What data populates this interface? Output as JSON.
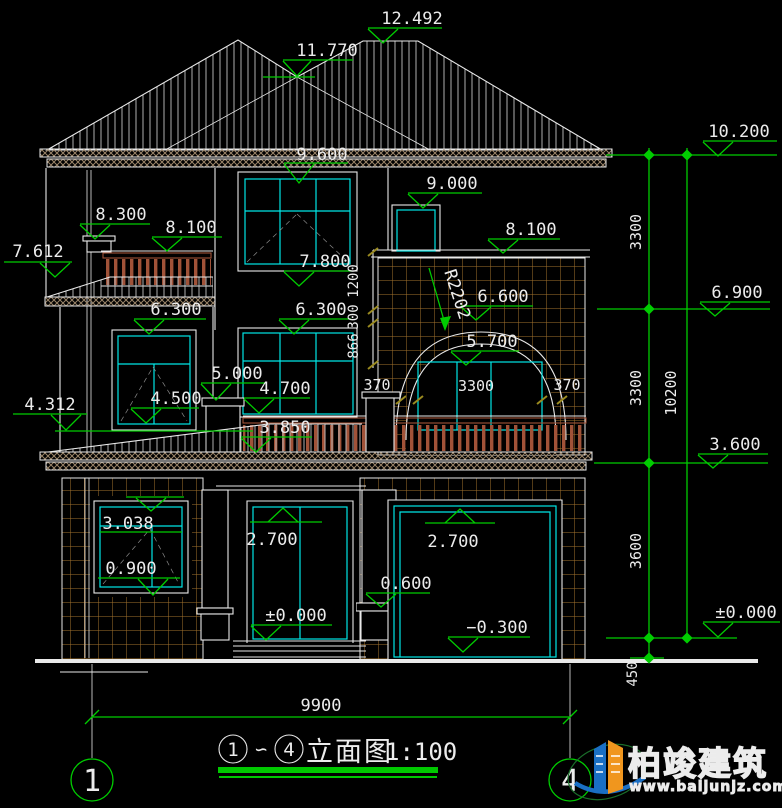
{
  "levels": {
    "ridge": "12.492",
    "hip": "11.770",
    "eave_right": "10.200",
    "eave": "9.600",
    "chimney_top": "9.000",
    "left_post": "8.300",
    "left_balcony": "8.100",
    "left_roof": "7.612",
    "big_window": "7.800",
    "flat_roof_right": "8.100",
    "second_floor_right": "6.900",
    "window2_left": "6.300",
    "window2_center": "6.300",
    "arch_top": "6.600",
    "arch_window": "5.700",
    "pedestal": "5.000",
    "window2_mid": "4.700",
    "window2_sill": "4.500",
    "roof1_eave_left": "4.312",
    "railing_base": "3.850",
    "first_roof_right": "3.600",
    "window1_head": "3.038",
    "door_head": "2.700",
    "garage_head": "2.700",
    "window1_sill": "0.900",
    "column_base": "0.600",
    "floor_door": "±0.000",
    "floor_right": "±0.000",
    "garage_floor": "−0.300"
  },
  "dims": {
    "story_upper": "3300",
    "story_middle": "3300",
    "story_lower": "3600",
    "total_height": "10200",
    "foundation": "450",
    "total_width": "9900",
    "arch_left": "370",
    "arch_center": "3300",
    "arch_right": "370",
    "parapet_top": "1200",
    "parapet_mid": "300",
    "parapet_bottom": "866"
  },
  "radius_label": "R2202",
  "grid_bubbles": {
    "left": "1",
    "right": "4"
  },
  "title": {
    "from": "1",
    "tilde": "∽",
    "to": "4",
    "name": "立面图",
    "scale": "1:100"
  },
  "logo": {
    "brand": "柏竣建筑",
    "url": "www.baijunjz.com"
  }
}
